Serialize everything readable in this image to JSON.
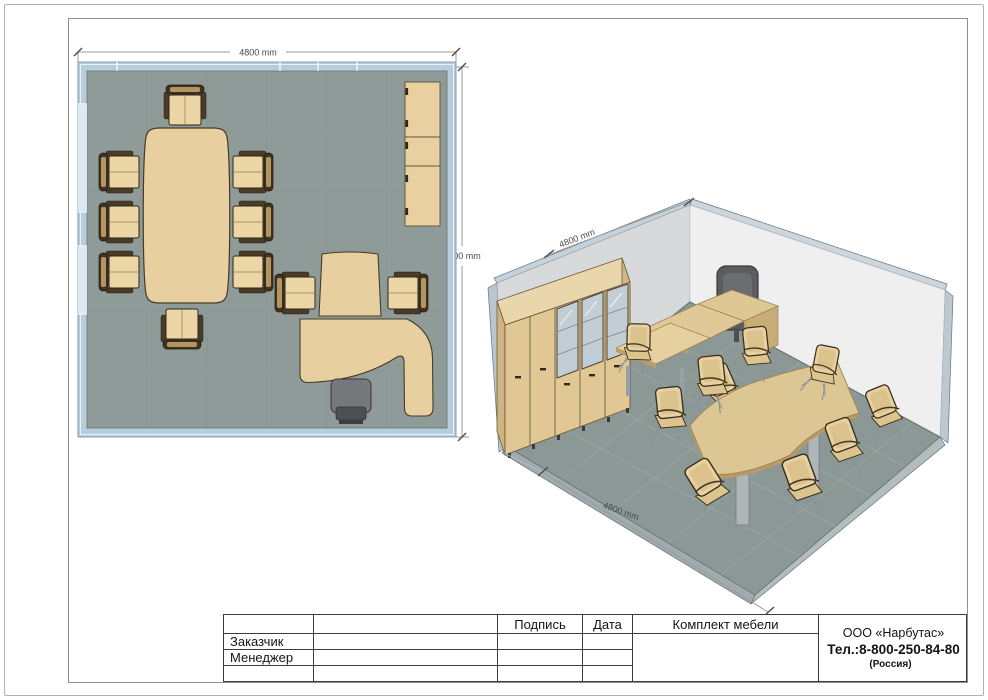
{
  "plan_view": {
    "width_dim": "4800 mm",
    "depth_dim": "4800 mm",
    "items": [
      "conference-table",
      "conference-chair",
      "wall-cabinet",
      "meeting-extension-table",
      "guest-chair",
      "executive-desk",
      "office-chair"
    ]
  },
  "iso_view": {
    "wall_dim": "4800 mm",
    "floor_dim": "4800 mm",
    "items": [
      "wardrobe-cabinet",
      "glass-cabinet",
      "executive-desk",
      "office-chair",
      "meeting-extension-table",
      "conference-table",
      "conference-chair",
      "guest-chair"
    ]
  },
  "title_block": {
    "signature_label": "Подпись",
    "date_label": "Дата",
    "furniture_set_label": "Комплект мебели",
    "customer_label": "Заказчик",
    "manager_label": "Менеджер",
    "company_name": "ООО «Нарбутас»",
    "company_phone": "Тел.:8-800-250-84-80",
    "company_country": "(Россия)"
  },
  "colors": {
    "plan_floor": "#8e9b98",
    "plan_wall": "#b7cddb",
    "window": "#dde9f1",
    "furniture_wood": "#e7cfa0",
    "wood_trim": "#4a3b26",
    "office_chair_gray": "#6f7174",
    "iso_left_wall": "#d7d9da",
    "iso_right_wall": "#efefef",
    "iso_floor": "#8b9895",
    "wall_edge_band": "#bcc9d1",
    "dimension_line": "#8a8a8a"
  }
}
